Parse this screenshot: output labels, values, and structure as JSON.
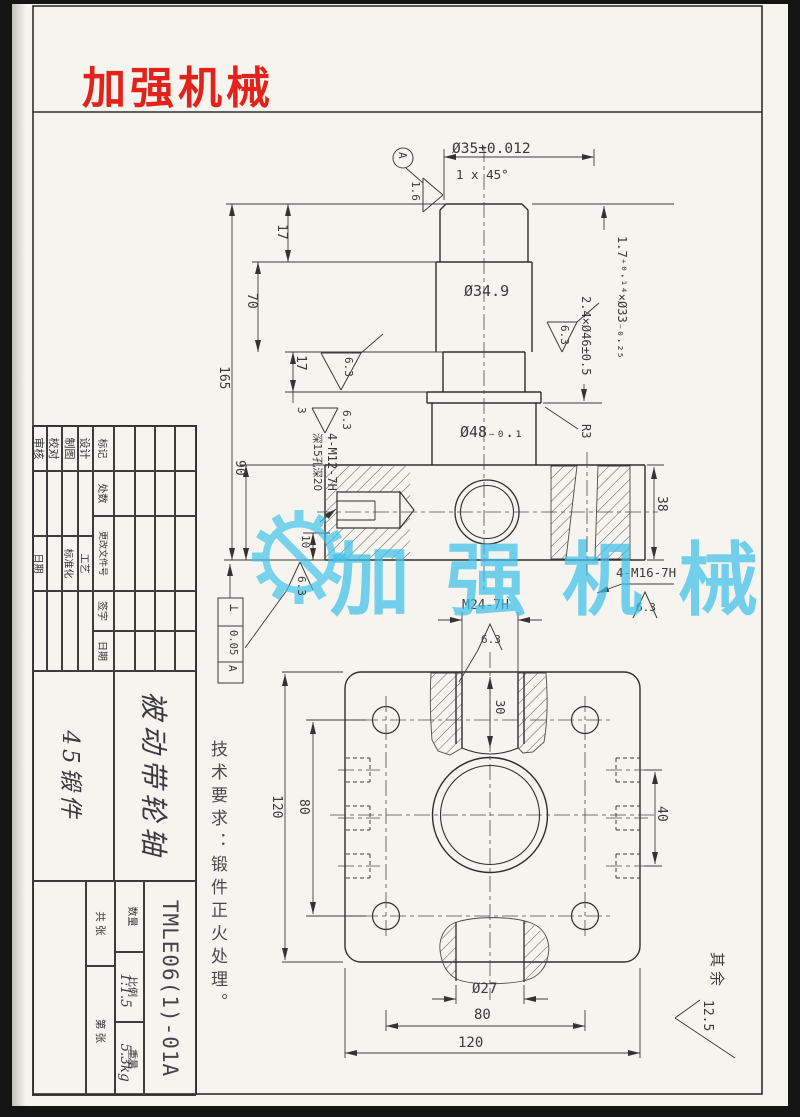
{
  "logo": {
    "text": "加强机械"
  },
  "watermark": {
    "text": "加强机械"
  },
  "notes": {
    "tech": "技术要求：锻件正火处理。",
    "rest_label": "其余",
    "rest_value": "12.5"
  },
  "front_view": {
    "dia35": "Ø35±0.012",
    "chamfer": "1 x 45°",
    "datum": "A",
    "rough16": "1.6",
    "d17a": "17",
    "d70": "70",
    "d165": "165",
    "d17b": "17",
    "d3": "3",
    "d90": "90",
    "dia349": "Ø34.9",
    "dia48": "Ø48₋₀.₁",
    "groove17": "1.7⁺⁰·¹⁴×Ø33₋₀.₂₅",
    "groove24": "2.4×Ø46±0.5",
    "rough63a": "6.3",
    "rough63b": "6.3",
    "rough63c": "6.3",
    "rough63d": "6.3",
    "rough63e": "6.3",
    "r3": "R3",
    "d38": "38",
    "m16": "4-M16-7H",
    "m12": "4-M12-7H",
    "m12_note": "深15孔深20",
    "d10": "10",
    "tol_sym": "⊥",
    "tol_val": "0.05",
    "tol_datum": "A"
  },
  "bottom_view": {
    "m24": "M24-7H",
    "rough63": "6.3",
    "d30": "30",
    "d120l": "120",
    "d80l": "80",
    "d40": "40",
    "dia27": "Ø27",
    "d80b": "80",
    "d120b": "120"
  },
  "title_block": {
    "rev_labels": [
      "标记",
      "处数",
      "更改文件号",
      "签字",
      "日期"
    ],
    "sig_left": [
      "设计",
      "制图",
      "校对",
      "审核"
    ],
    "sig_right": [
      "工艺",
      "标准化",
      "",
      "日期"
    ],
    "part_name": "被动带轮轴",
    "material": "45锻件",
    "drawing_no": "TMLE06(1)-01A",
    "qty_label": "数量",
    "scale_label": "比例",
    "scale_value": "1:1.5",
    "weight_label": "重量",
    "weight_value": "5.3kg",
    "sheet_total": "共 张",
    "sheet_no": "第 张"
  }
}
